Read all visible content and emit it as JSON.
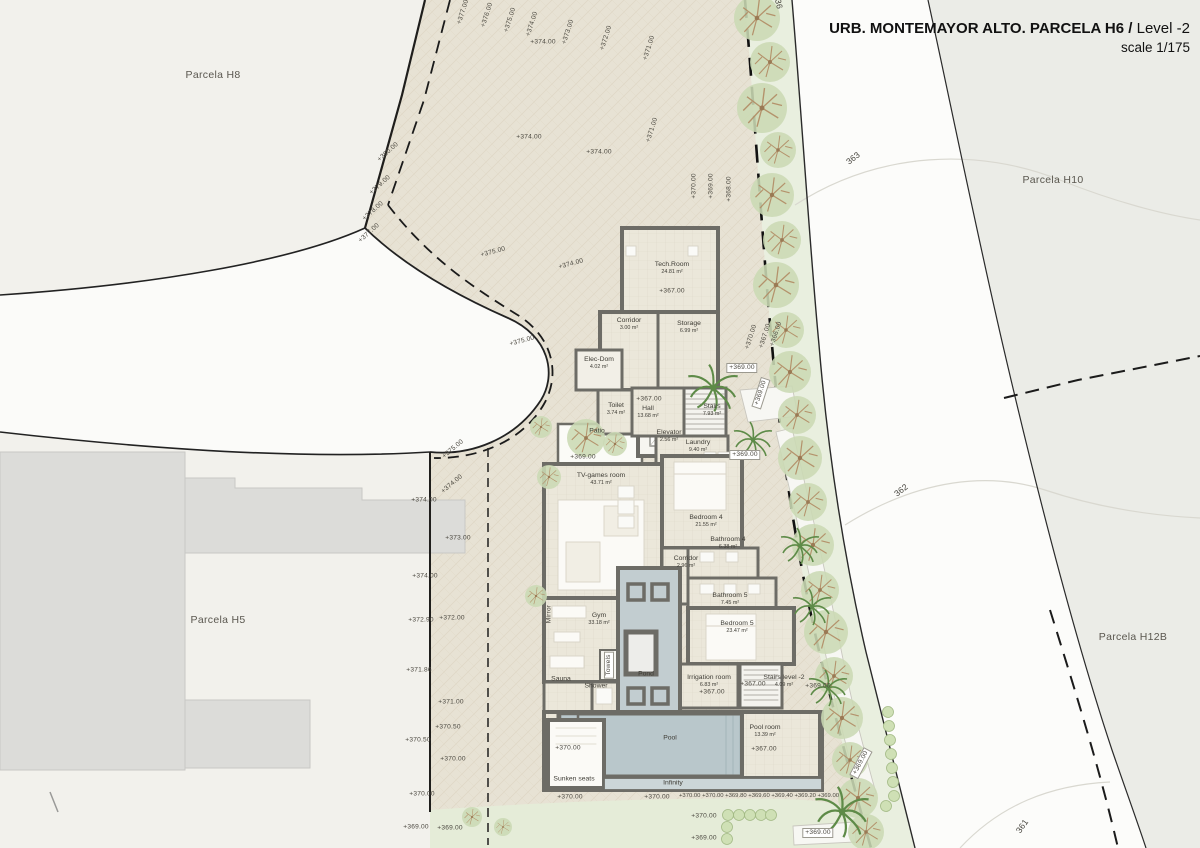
{
  "title": {
    "main": "URB. MONTEMAYOR ALTO. PARCELA H6 /",
    "level": " Level -2",
    "scale": "scale 1/175"
  },
  "rooms": [
    {
      "name": "Tech.Room",
      "area": "24.81 m²",
      "x": 672,
      "y": 268
    },
    {
      "name": "Corridor",
      "area": "3.00 m²",
      "x": 629,
      "y": 324
    },
    {
      "name": "Storage",
      "area": "6.99 m²",
      "x": 689,
      "y": 327
    },
    {
      "name": "Elec-Dom",
      "area": "4.02 m²",
      "x": 599,
      "y": 363
    },
    {
      "name": "Elevator",
      "area": "2.56 m²",
      "x": 669,
      "y": 436
    },
    {
      "name": "Toilet",
      "area": "3.74 m²",
      "x": 616,
      "y": 409
    },
    {
      "name": "Hall",
      "area": "13.68 m²",
      "x": 648,
      "y": 412
    },
    {
      "name": "Stairs",
      "area": "7.93 m²",
      "x": 712,
      "y": 410
    },
    {
      "name": "Laundry",
      "area": "9.40 m²",
      "x": 698,
      "y": 446
    },
    {
      "name": "Patio",
      "area": "",
      "x": 597,
      "y": 431
    },
    {
      "name": "TV-games room",
      "area": "43.71 m²",
      "x": 601,
      "y": 479
    },
    {
      "name": "Bedroom 4",
      "area": "21.55 m²",
      "x": 706,
      "y": 521
    },
    {
      "name": "Bathroom 4",
      "area": "6.38 m²",
      "x": 728,
      "y": 543
    },
    {
      "name": "Corridor",
      "area": "2.96 m²",
      "x": 686,
      "y": 562
    },
    {
      "name": "Bathroom 5",
      "area": "7.45 m²",
      "x": 730,
      "y": 599
    },
    {
      "name": "Gym",
      "area": "33.18 m²",
      "x": 599,
      "y": 619
    },
    {
      "name": "Bedroom 5",
      "area": "23.47 m²",
      "x": 737,
      "y": 627
    },
    {
      "name": "Sauna",
      "area": "",
      "x": 561,
      "y": 679
    },
    {
      "name": "Shower",
      "area": "",
      "x": 596,
      "y": 686
    },
    {
      "name": "Pond",
      "area": "",
      "x": 646,
      "y": 674
    },
    {
      "name": "Irrigation room",
      "area": "6.83 m²",
      "x": 709,
      "y": 681
    },
    {
      "name": "Stairs level -2",
      "area": "4.09 m²",
      "x": 784,
      "y": 681
    },
    {
      "name": "Pool",
      "area": "",
      "x": 670,
      "y": 738
    },
    {
      "name": "Pool room",
      "area": "13.39 m²",
      "x": 765,
      "y": 731
    },
    {
      "name": "Sunken seats",
      "area": "",
      "x": 574,
      "y": 779
    },
    {
      "name": "Infinity",
      "area": "",
      "x": 673,
      "y": 783
    }
  ],
  "annotations": [
    {
      "t": "+377.00",
      "x": 463,
      "y": 12,
      "r": -72
    },
    {
      "t": "+376.00",
      "x": 487,
      "y": 15,
      "r": -72
    },
    {
      "t": "+375.00",
      "x": 510,
      "y": 20,
      "r": -72
    },
    {
      "t": "+374.00",
      "x": 532,
      "y": 24,
      "r": -72
    },
    {
      "t": "+373.00",
      "x": 568,
      "y": 32,
      "r": -72
    },
    {
      "t": "+372.00",
      "x": 606,
      "y": 38,
      "r": -72
    },
    {
      "t": "+371.00",
      "x": 649,
      "y": 48,
      "r": -72
    },
    {
      "t": "+371.00",
      "x": 652,
      "y": 130,
      "r": -72
    },
    {
      "t": "+370.00",
      "x": 694,
      "y": 186,
      "r": -90
    },
    {
      "t": "+369.00",
      "x": 711,
      "y": 186,
      "r": -90
    },
    {
      "t": "+368.00",
      "x": 729,
      "y": 189,
      "r": -90
    },
    {
      "t": "+374.00",
      "x": 543,
      "y": 42
    },
    {
      "t": "+374.00",
      "x": 529,
      "y": 137
    },
    {
      "t": "+374.00",
      "x": 599,
      "y": 152
    },
    {
      "t": "+380.00",
      "x": 388,
      "y": 152,
      "r": -42
    },
    {
      "t": "+379.00",
      "x": 380,
      "y": 185,
      "r": -42
    },
    {
      "t": "+378.00",
      "x": 373,
      "y": 211,
      "r": -42
    },
    {
      "t": "+377.00",
      "x": 369,
      "y": 233,
      "r": -42
    },
    {
      "t": "+375.00",
      "x": 493,
      "y": 252,
      "r": -15
    },
    {
      "t": "+374.00",
      "x": 571,
      "y": 264,
      "r": -15
    },
    {
      "t": "+375.00",
      "x": 522,
      "y": 341,
      "r": -15
    },
    {
      "t": "+370.00",
      "x": 751,
      "y": 337,
      "r": -72
    },
    {
      "t": "+367.00",
      "x": 765,
      "y": 336,
      "r": -72
    },
    {
      "t": "+366.00",
      "x": 776,
      "y": 334,
      "r": -72
    },
    {
      "t": "+369.00",
      "x": 761,
      "y": 393,
      "r": -72,
      "cls": "box"
    },
    {
      "t": "+369.00",
      "x": 861,
      "y": 763,
      "r": -62,
      "cls": "box"
    },
    {
      "t": "+367.00",
      "x": 672,
      "y": 291
    },
    {
      "t": "+369.00",
      "x": 742,
      "y": 368,
      "cls": "box"
    },
    {
      "t": "+367.00",
      "x": 649,
      "y": 399
    },
    {
      "t": "+369.00",
      "x": 583,
      "y": 457
    },
    {
      "t": "+369.00",
      "x": 745,
      "y": 455,
      "cls": "box"
    },
    {
      "t": "+367.00",
      "x": 712,
      "y": 692
    },
    {
      "t": "+367.00",
      "x": 753,
      "y": 684
    },
    {
      "t": "+369.00",
      "x": 818,
      "y": 686
    },
    {
      "t": "+367.00",
      "x": 764,
      "y": 749
    },
    {
      "t": "+370.00",
      "x": 568,
      "y": 748
    },
    {
      "t": "+370.00",
      "x": 570,
      "y": 797
    },
    {
      "t": "+370.00",
      "x": 657,
      "y": 797
    },
    {
      "t": "+370.00 +370.00 +369.80 +369.60 +369.40 +369.20 +369.00",
      "x": 759,
      "y": 796,
      "cls": "small"
    },
    {
      "t": "+370.00",
      "x": 704,
      "y": 816
    },
    {
      "t": "+369.00",
      "x": 704,
      "y": 838
    },
    {
      "t": "+369.00",
      "x": 818,
      "y": 833,
      "cls": "box"
    },
    {
      "t": "+374.00",
      "x": 424,
      "y": 500
    },
    {
      "t": "+374.00",
      "x": 425,
      "y": 576
    },
    {
      "t": "+372.90",
      "x": 421,
      "y": 620
    },
    {
      "t": "+371.86",
      "x": 419,
      "y": 670
    },
    {
      "t": "+370.50",
      "x": 418,
      "y": 740
    },
    {
      "t": "+370.00",
      "x": 422,
      "y": 794
    },
    {
      "t": "+369.00",
      "x": 416,
      "y": 827
    },
    {
      "t": "+375.00",
      "x": 453,
      "y": 449,
      "r": -40
    },
    {
      "t": "+374.00",
      "x": 452,
      "y": 484,
      "r": -40
    },
    {
      "t": "+373.00",
      "x": 458,
      "y": 538
    },
    {
      "t": "+372.00",
      "x": 452,
      "y": 618
    },
    {
      "t": "+371.00",
      "x": 451,
      "y": 702
    },
    {
      "t": "+370.50",
      "x": 448,
      "y": 727
    },
    {
      "t": "+370.00",
      "x": 453,
      "y": 759
    },
    {
      "t": "+369.00",
      "x": 450,
      "y": 828
    },
    {
      "t": "Mirror",
      "x": 549,
      "y": 614,
      "r": -90
    },
    {
      "t": "Towels",
      "x": 609,
      "y": 665,
      "r": -90,
      "cls": "box"
    },
    {
      "t": "363",
      "x": 853,
      "y": 158,
      "r": -38,
      "cls": "contour"
    },
    {
      "t": "362",
      "x": 901,
      "y": 490,
      "r": -38,
      "cls": "contour"
    },
    {
      "t": "361",
      "x": 1022,
      "y": 826,
      "r": -55,
      "cls": "contour"
    },
    {
      "t": "36",
      "x": 779,
      "y": 4,
      "r": 78,
      "cls": "contour"
    },
    {
      "t": "Parcela H8",
      "x": 213,
      "y": 75,
      "cls": "parcel"
    },
    {
      "t": "Parcela H10",
      "x": 1053,
      "y": 180,
      "cls": "parcel"
    },
    {
      "t": "Parcela H5",
      "x": 218,
      "y": 620,
      "cls": "parcel"
    },
    {
      "t": "Parcela H12B",
      "x": 1133,
      "y": 637,
      "cls": "parcel"
    }
  ],
  "colors": {
    "ground_tan": "#e7e2d4",
    "road_white": "#fcfcfa",
    "parcel_gray": "#ebece7",
    "pool_blue": "#b9c7cb",
    "wall_gray": "#6d6c66",
    "tree_green": "#cbd9b4",
    "grass": "#e5ecd8"
  }
}
